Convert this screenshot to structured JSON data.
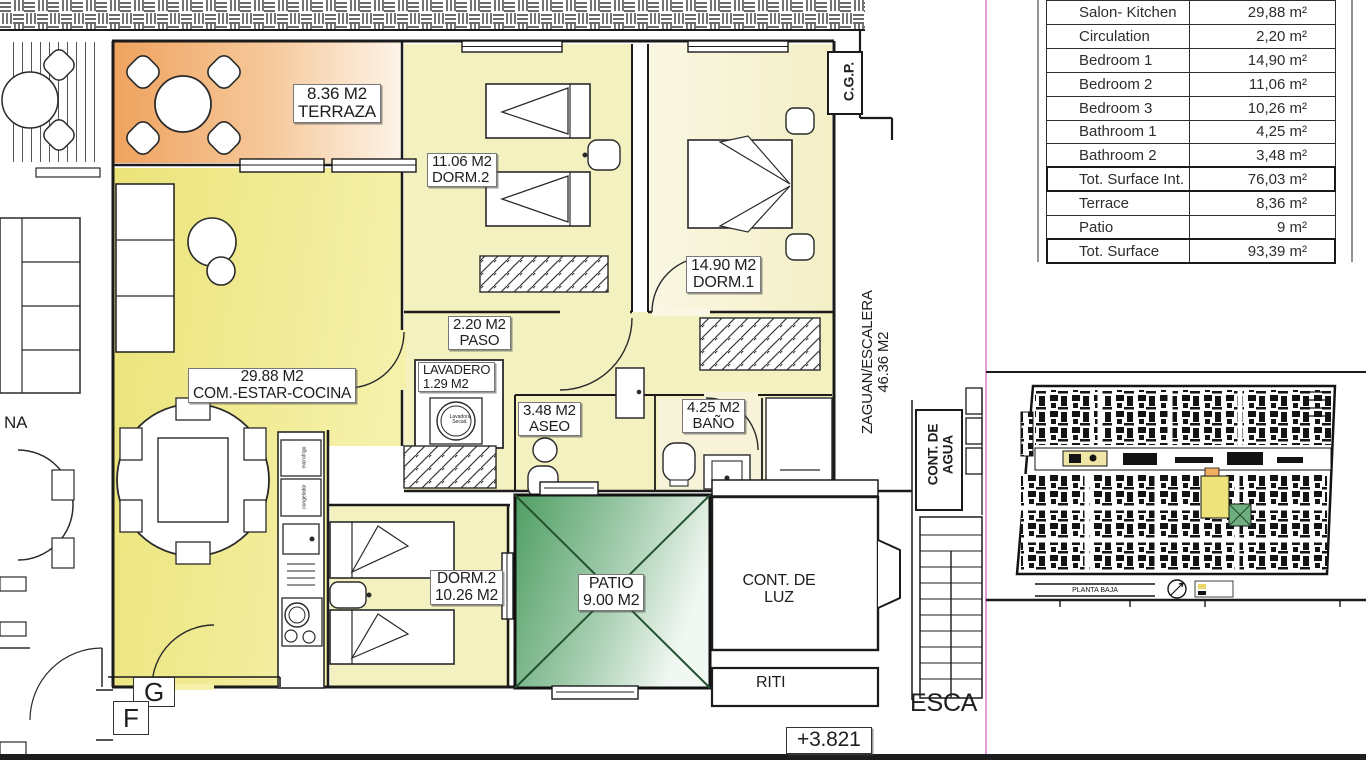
{
  "table": {
    "rows": [
      {
        "label": "Salon- Kitchen",
        "value": "29,88 m²"
      },
      {
        "label": "Circulation",
        "value": "2,20 m²"
      },
      {
        "label": "Bedroom 1",
        "value": "14,90 m²"
      },
      {
        "label": "Bedroom 2",
        "value": "11,06 m²"
      },
      {
        "label": "Bedroom 3",
        "value": "10,26 m²"
      },
      {
        "label": "Bathroom 1",
        "value": "4,25 m²"
      },
      {
        "label": "Bathroom 2",
        "value": "3,48 m²"
      },
      {
        "label": "Tot. Surface Int.",
        "value": "76,03 m²"
      },
      {
        "label": "Terrace",
        "value": "8,36 m²"
      },
      {
        "label": "Patio",
        "value": "9 m²"
      },
      {
        "label": "Tot. Surface",
        "value": "93,39 m²"
      }
    ]
  },
  "plan": {
    "terraza": {
      "area": "8.36 M2",
      "name": "TERRAZA"
    },
    "dorm2_top": {
      "area": "11.06 M2",
      "name": "DORM.2"
    },
    "dorm1": {
      "area": "14.90 M2",
      "name": "DORM.1"
    },
    "living": {
      "area": "29.88 M2",
      "name": "COM.-ESTAR-COCINA"
    },
    "paso": {
      "area": "2.20 M2",
      "name": "PASO"
    },
    "lavadero": {
      "name": "LAVADERO",
      "area": "1.29 M2"
    },
    "aseo": {
      "area": "3.48 M2",
      "name": "ASEO"
    },
    "bano": {
      "area": "4.25 M2",
      "name": "BAÑO"
    },
    "dorm3": {
      "name": "DORM.2",
      "area": "10.26 M2"
    },
    "patio": {
      "name": "PATIO",
      "area": "9.00 M2"
    },
    "cont_luz": {
      "line1": "CONT. DE",
      "line2": "LUZ"
    },
    "riti": "RITI",
    "zaguan": {
      "name": "ZAGUAN/ESCALERA",
      "area": "46.36 M2"
    },
    "cont_agua": {
      "line1": "CONT. DE",
      "line2": "AGUA"
    },
    "cgp": "C.G.P.",
    "level": "+3.821",
    "esca": "ESCA",
    "unit_g": "G",
    "unit_f": "F",
    "na": "NA",
    "washer": {
      "line1": "Lavadora",
      "line2": "Secad."
    },
    "kitchen": {
      "appl1": "microfrigo",
      "appl2": "congelador"
    }
  },
  "mini": {
    "caption": "PLANTA BAJA"
  },
  "colors": {
    "terrace_orange": "#f0a360",
    "living_yellow": "#eee88a",
    "bedroom_cream": "#f4f1c0",
    "patio_green": "#4f9e63",
    "accent_magenta": "#d884c8"
  }
}
